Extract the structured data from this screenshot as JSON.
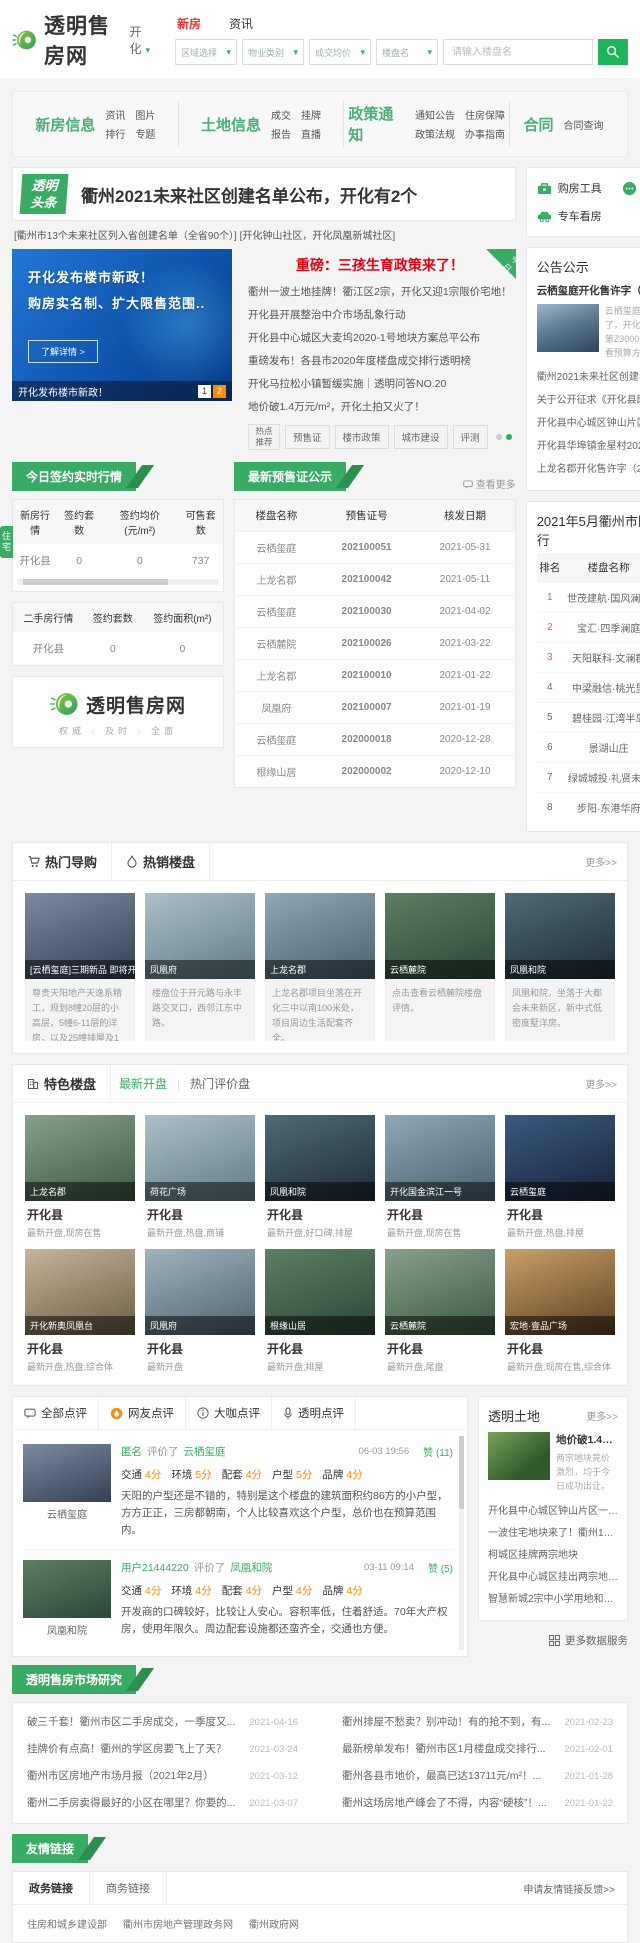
{
  "colors": {
    "brand_green": "#3aab64",
    "button_green": "#1db45a",
    "active_red": "#e83632",
    "news_red": "#e60012",
    "score_orange": "#ff8800",
    "page_orange": "#ff8a00"
  },
  "header": {
    "logo_text": "透明售房网",
    "city": "开化",
    "tabs": [
      {
        "label": "新房"
      },
      {
        "label": "资讯"
      }
    ],
    "filters": [
      "区域选择",
      "物业类别",
      "成交均价",
      "楼盘名"
    ],
    "search_placeholder": "请输入楼盘名"
  },
  "nav": {
    "groups": [
      {
        "title": "新房信息",
        "links": [
          "资讯",
          "图片",
          "排行",
          "专题"
        ]
      },
      {
        "title": "土地信息",
        "links": [
          "成交",
          "挂牌",
          "报告",
          "直播"
        ]
      },
      {
        "title": "政策通知",
        "links": [
          "通知公告",
          "住房保障",
          "政策法规",
          "办事指南"
        ]
      },
      {
        "title": "合同",
        "links": [
          "合同查询"
        ]
      }
    ]
  },
  "headline": {
    "badge": "透明头条",
    "title": "衢州2021未来社区创建名单公布，开化有2个",
    "subtitle": "[衢州市13个未来社区列入省创建名单（全省90个）] [开化钟山社区，开化凤凰新城社区]"
  },
  "banner": {
    "line1": "开化发布楼市新政！",
    "line2": "购房实名制、扩大限售范围..",
    "button": "了解详情 >",
    "caption": "开化发布楼市新政！",
    "page1": "1",
    "page2": "2"
  },
  "news": {
    "badge": "今日",
    "top_title": "重磅：三孩生育政策来了！",
    "items": [
      "衢州一波土地挂牌！衢江区2宗，开化又迎1宗限价宅地！",
      "开化县开展整治中介市场乱象行动",
      "开化县中心城区大麦坞2020-1号地块方案总平公布",
      "重磅发布！各县市2020年度楼盘成交排行透明榜",
      "开化马拉松小镇暂缓实施｜透明问答NO.20",
      "地价破1.4万元/m²，开化土拍又火了！"
    ],
    "tag_hot": "热点推荐",
    "tags": [
      "预售证",
      "楼市政策",
      "城市建设",
      "评测"
    ]
  },
  "tools": {
    "items": [
      "购房工具",
      "我要咨询",
      "专车看房"
    ]
  },
  "announce": {
    "title": "公告公示",
    "more": "更多>>",
    "feat_title": "云栖玺庭开化售许字（2021）第Z300051号预...",
    "feat_desc": "云栖玺庭三期预售证来了，开化售许字（2021）第Z300051号，点击查看预算方案。",
    "items": [
      "衢州2021未来社区创建名单公布，开化有2个未",
      "关于公开征求《开化县既有住宅加装电梯工作实...",
      "开化县中心城区钟山片区2020-1号地块方案设",
      "开化县华埠镇金星村2021-1号地块总平面图批",
      "上龙名郡开化售许字（2021）第Z300042"
    ]
  },
  "market": {
    "ribbon": "今日签约实时行情",
    "unit_tab": "住宅",
    "new_house": {
      "headers": [
        "新房行情",
        "签约套数",
        "签约均价 (元/m²)",
        "可售套数"
      ],
      "row": [
        "开化县",
        "0",
        "0",
        "737"
      ]
    },
    "second_hand": {
      "headers": [
        "二手房行情",
        "签约套数",
        "签约面积(m²)"
      ],
      "row": [
        "开化县",
        "0",
        "0"
      ]
    }
  },
  "brand": {
    "name": "透明售房网",
    "slogan": "权威 · 及时 · 全面"
  },
  "presale": {
    "ribbon": "最新预售证公示",
    "more": "查看更多",
    "headers": [
      "楼盘名称",
      "预售证号",
      "核发日期"
    ],
    "rows": [
      [
        "云栖玺庭",
        "202100051",
        "2021-05-31"
      ],
      [
        "上龙名郡",
        "202100042",
        "2021-05-11"
      ],
      [
        "云栖玺庭",
        "202100030",
        "2021-04-02"
      ],
      [
        "云栖麓院",
        "202100026",
        "2021-03-22"
      ],
      [
        "上龙名郡",
        "202100010",
        "2021-01-22"
      ],
      [
        "凤凰府",
        "202100007",
        "2021-01-19"
      ],
      [
        "云栖玺庭",
        "202000018",
        "2020-12-28"
      ],
      [
        "根缘山居",
        "202000002",
        "2020-12-10"
      ]
    ]
  },
  "ranking": {
    "title": "2021年5月衢州市区签约排行",
    "headers": [
      "排名",
      "楼盘名称",
      "签约套数"
    ],
    "rows": [
      [
        "1",
        "世茂建航·国风澜园",
        "88"
      ],
      [
        "2",
        "宝汇·四季澜庭",
        "63"
      ],
      [
        "3",
        "天阳联科·文澜郡",
        "52"
      ],
      [
        "4",
        "中梁融信·桃光里",
        "34"
      ],
      [
        "5",
        "碧桂园·江湾半岛",
        "32"
      ],
      [
        "6",
        "景湖山庄",
        "23"
      ],
      [
        "7",
        "绿城城投·礼贤未...",
        "18"
      ],
      [
        "8",
        "步阳·东港华府",
        "17"
      ]
    ]
  },
  "hot": {
    "tab1": "热门导购",
    "tab2": "热销楼盘",
    "more": "更多>>",
    "cards": [
      {
        "label": "[云栖玺庭]三期新品 即将开盘",
        "desc": "尊贵天阳地产天逸系精工，规划8幢20层的小高层，5幢6-11层的洋房，以及25幢排屋及1"
      },
      {
        "label": "凤凰府",
        "desc": "楼盘位于开元路与永丰路交叉口，西邻江东中路。"
      },
      {
        "label": "上龙名郡",
        "desc": "上龙名郡项目坐落在开化三中以南100米处，项目周边生活配套齐全。"
      },
      {
        "label": "云栖麓院",
        "desc": "点击查看云栖麓院楼盘评情。"
      },
      {
        "label": "凤凰和院",
        "desc": "凤凰和院，坐落于大都会未来新区，新中式低密度墅洋房。"
      }
    ]
  },
  "featured": {
    "title": "特色楼盘",
    "tab1": "最新开盘",
    "tab2": "热门评价盘",
    "more": "更多>>",
    "cards": [
      {
        "name": "上龙名郡",
        "district": "开化县",
        "tags": "最新开盘,现房在售"
      },
      {
        "name": "荷花广场",
        "district": "开化县",
        "tags": "最新开盘,热盘,商铺"
      },
      {
        "name": "凤凰和院",
        "district": "开化县",
        "tags": "最新开盘,好口碑,排屋"
      },
      {
        "name": "开化国金滨江一号",
        "district": "开化县",
        "tags": "最新开盘,现房在售"
      },
      {
        "name": "云栖玺庭",
        "district": "开化县",
        "tags": "最新开盘,热盘,排屋"
      },
      {
        "name": "开化新奥凤凰台",
        "district": "开化县",
        "tags": "最新开盘,热盘,综合体"
      },
      {
        "name": "凤凰府",
        "district": "开化县",
        "tags": "最新开盘"
      },
      {
        "name": "根缘山居",
        "district": "开化县",
        "tags": "最新开盘,排屋"
      },
      {
        "name": "云栖麓院",
        "district": "开化县",
        "tags": "最新开盘,尾盘"
      },
      {
        "name": "宏地·壹品广场",
        "district": "开化县",
        "tags": "最新开盘,现房在售,综合体"
      }
    ]
  },
  "reviews": {
    "tabs": [
      "全部点评",
      "网友点评",
      "大咖点评",
      "透明点评"
    ],
    "items": [
      {
        "project": "云栖玺庭",
        "user": "匿名",
        "action": "评价了",
        "target": "云栖玺庭",
        "date": "06-03 19:56",
        "likes": "赞 (11)",
        "scores": [
          {
            "k": "交通",
            "v": "4分"
          },
          {
            "k": "环境",
            "v": "5分"
          },
          {
            "k": "配套",
            "v": "4分"
          },
          {
            "k": "户型",
            "v": "5分"
          },
          {
            "k": "品牌",
            "v": "4分"
          }
        ],
        "text": "天阳的户型还是不错的，特别是这个楼盘的建筑面积约86方的小户型，方方正正，三房都朝南，个人比较喜欢这个户型，总价也在预算范围内。"
      },
      {
        "project": "凤凰和院",
        "user": "用户21444220",
        "action": "评价了",
        "target": "凤凰和院",
        "date": "03-11 09:14",
        "likes": "赞 (5)",
        "scores": [
          {
            "k": "交通",
            "v": "4分"
          },
          {
            "k": "环境",
            "v": "4分"
          },
          {
            "k": "配套",
            "v": "4分"
          },
          {
            "k": "户型",
            "v": "4分"
          },
          {
            "k": "品牌",
            "v": "4分"
          }
        ],
        "text": "开发商的口碑较好，比较让人安心。容积率低，住着舒适。70年大产权房，使用年限久。周边配套设施都还蛮齐全，交通也方便。"
      }
    ]
  },
  "land": {
    "title": "透明土地",
    "more": "更多>>",
    "feat_title": "地价破1.4万元/m²，...",
    "feat_desc": "两宗地块竞价激烈，均于今日成功出让。",
    "items": [
      "开化县中心城区钟山片区一宗地块成交，12387",
      "一波住宅地块来了！衢州12月迎推地高峰，涉宅地",
      "柯城区挂牌两宗地块",
      "开化县中心城区挂出两宗地块，将于8月19日上午",
      "智慧新城2宗中小学用地和1宗商住地调整公示"
    ],
    "services": "更多数据服务"
  },
  "research": {
    "ribbon": "透明售房市场研究",
    "items": [
      {
        "t": "破三千套！衢州市区二手房成交，一季度又...",
        "d": "2021-04-16"
      },
      {
        "t": "挂牌价有点高！衢州的学区房要飞上了天？",
        "d": "2021-03-24"
      },
      {
        "t": "衢州市区房地产市场月报（2021年2月）",
        "d": "2021-03-12"
      },
      {
        "t": "衢州二手房卖得最好的小区在哪里？你要的...",
        "d": "2021-03-07"
      },
      {
        "t": "衢州排屋不愁卖？别冲动！有的抢不到，有...",
        "d": "2021-02-23"
      },
      {
        "t": "最新榜单发布！衢州市区1月楼盘成交排行...",
        "d": "2021-02-01"
      },
      {
        "t": "衢州各县市地价，最高已达13711元/m²！...",
        "d": "2021-01-28"
      },
      {
        "t": "衢州这场房地产峰会了不得，内容“硬核”！...",
        "d": "2021-01-22"
      }
    ]
  },
  "footer": {
    "ribbon": "友情链接",
    "tab1": "政务链接",
    "tab2": "商务链接",
    "apply": "申请友情链接反馈>>",
    "links": [
      "住房和城乡建设部",
      "衢州市房地产管理政务网",
      "衢州政府网"
    ]
  }
}
